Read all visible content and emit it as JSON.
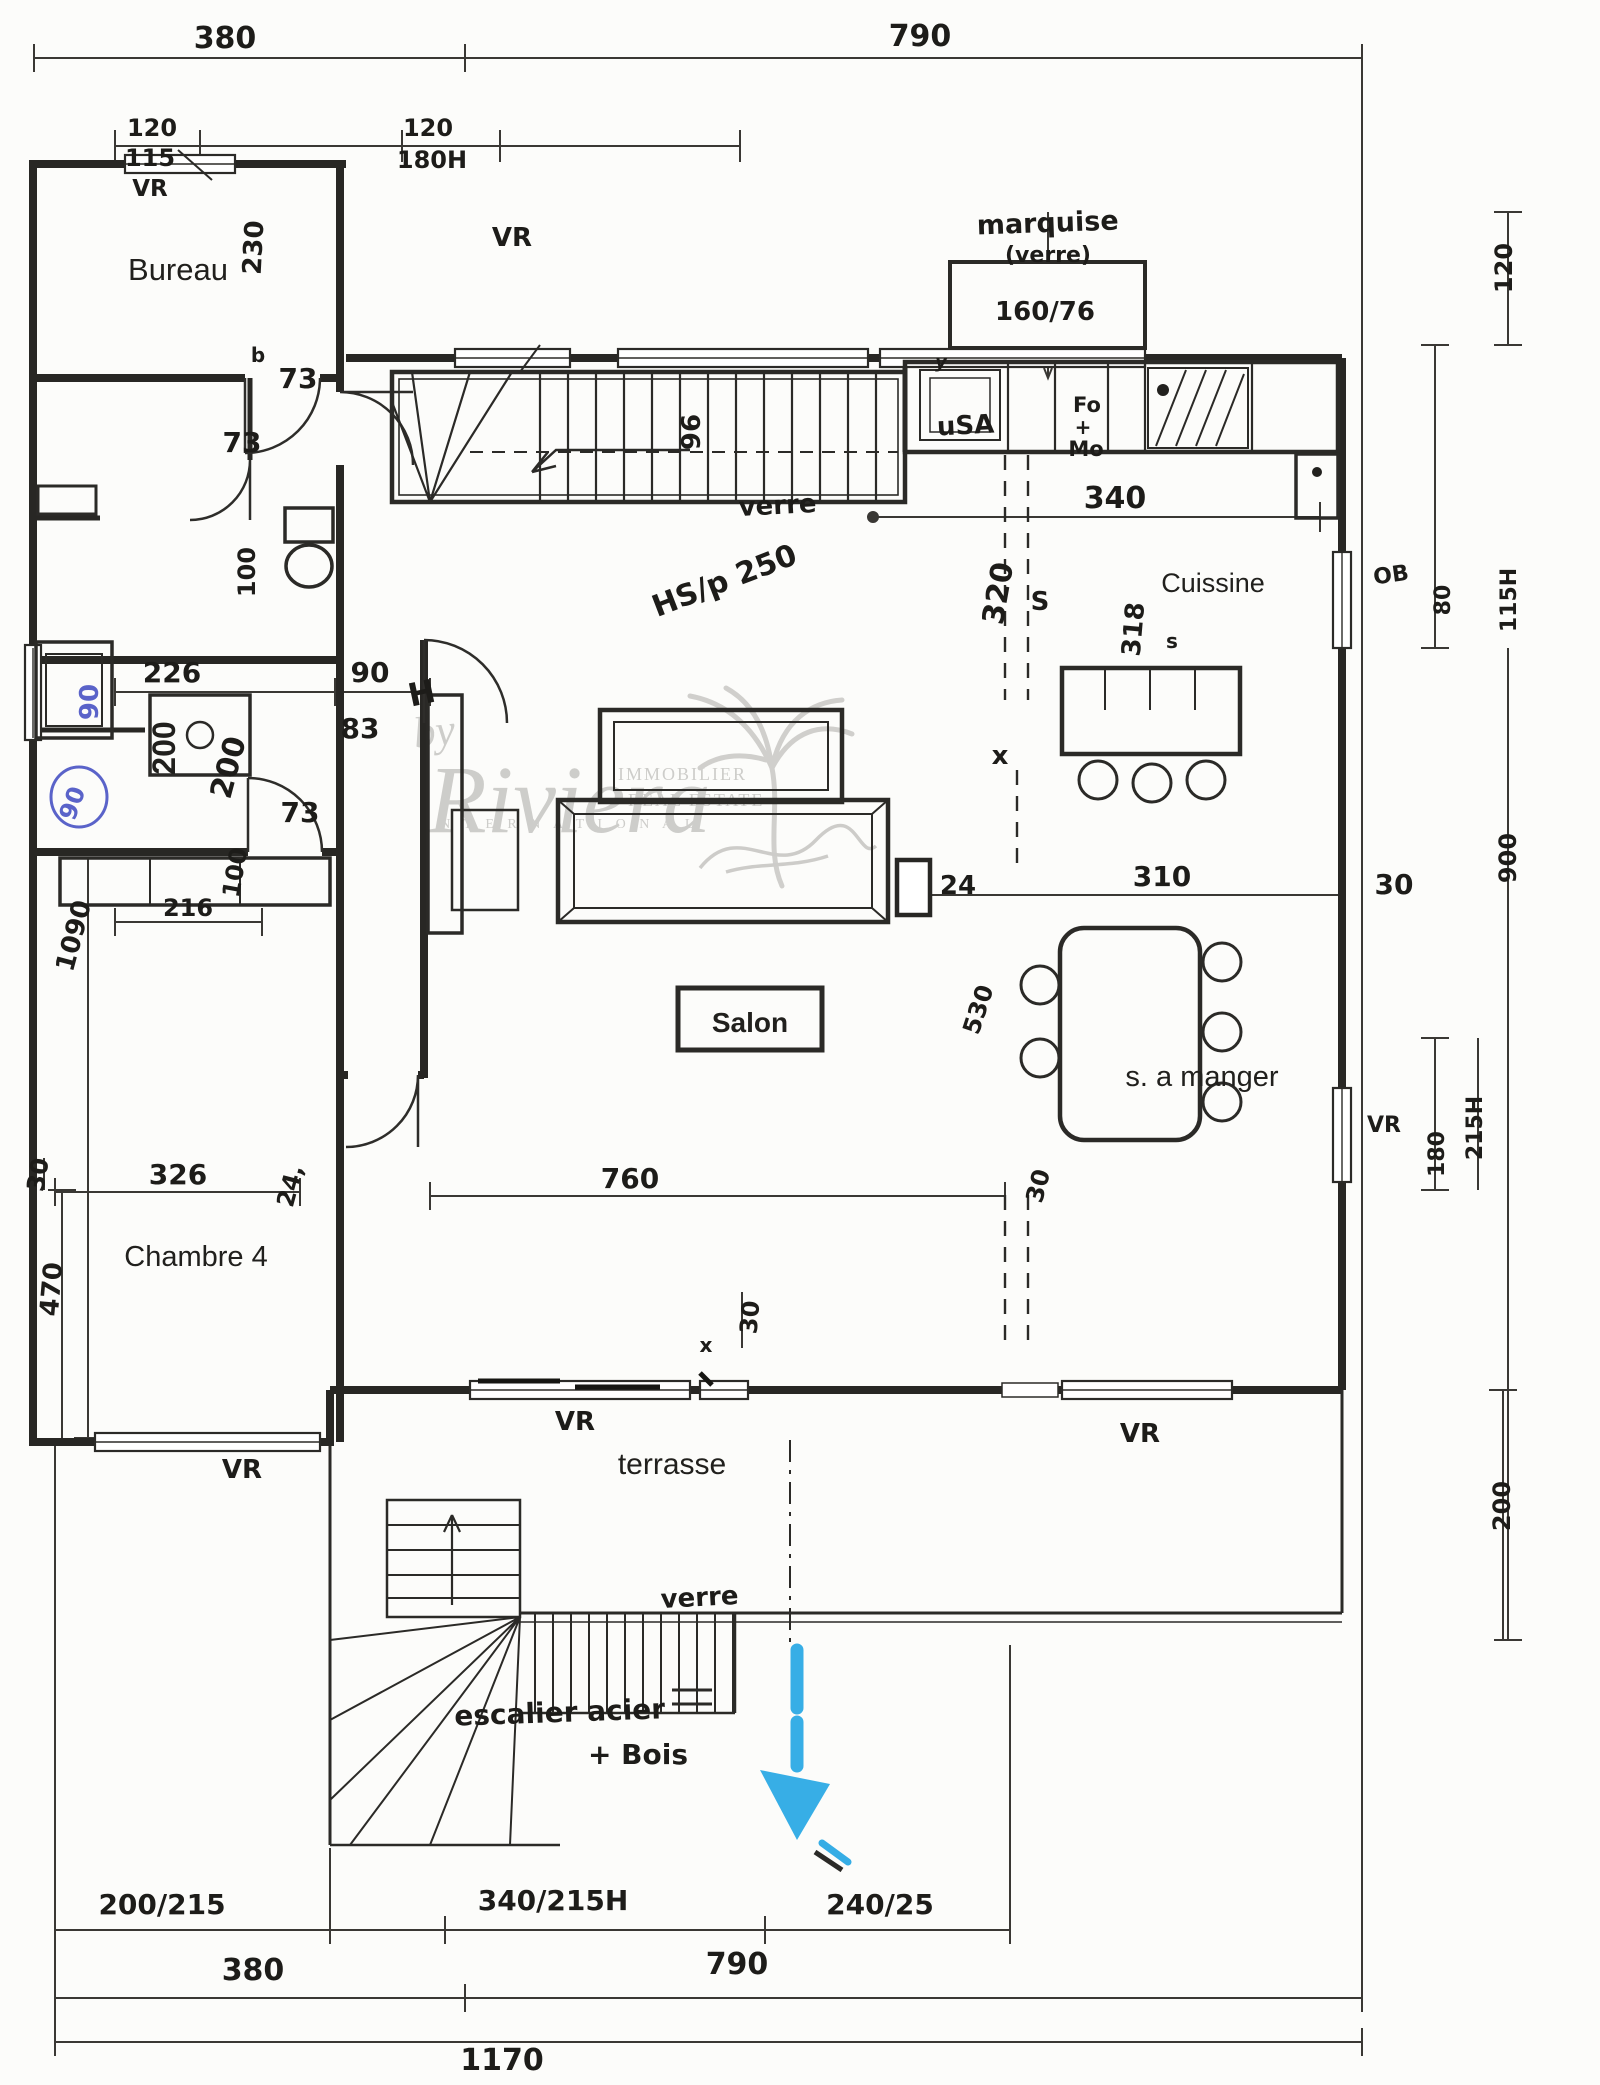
{
  "document": {
    "kind": "scanned hand-drawn floor plan",
    "language": "French"
  },
  "wm": {
    "by": "by",
    "brand": "Riviera",
    "l1": "IMMOBILIER",
    "l2": "REAL ESTATE",
    "l3": "I N T E R N A T I O N A L"
  },
  "rooms": {
    "bureau": "Bureau",
    "cuisine": "Cuissine",
    "chambre": "Chambre 4",
    "salon": "Salon",
    "manger": "s. a manger",
    "terrasse": "terrasse"
  },
  "lab": {
    "vr": "VR",
    "marquise": "marquise",
    "verre_p": "(verre)",
    "y": "y",
    "usa": "uSA",
    "fo": "Fo",
    "plus": "+",
    "mo": "Mo",
    "ob": "OB",
    "verre1": "verre",
    "verre2": "verre",
    "hsp": "HS/p 250",
    "x": "x",
    "b": "b",
    "h": "H",
    "esc1": "escalier acier",
    "esc2": "+ Bois"
  },
  "dim": {
    "t380": "380",
    "t790": "790",
    "t120a": "120",
    "t115": "115",
    "t120b": "120",
    "t180h": "180H",
    "mq": "160/76",
    "r120": "120",
    "r80": "80",
    "r115h": "115H",
    "r900": "900",
    "r215h": "215H",
    "r180": "180",
    "r200": "200",
    "b230": "230",
    "s96": "96",
    "k340": "340",
    "k320": "320",
    "kS": "S",
    "k318": "318",
    "ks": "s",
    "w100a": "100",
    "w226": "226",
    "h90": "90",
    "b90a": "90",
    "b90b": "90",
    "p200": "200",
    "h200": "200",
    "d83": "83",
    "d73a": "73",
    "d73b": "73",
    "d73c": "73",
    "w100b": "100",
    "l1090": "1090",
    "b216": "216",
    "s24": "24",
    "d310": "310",
    "r30": "30",
    "v530": "530",
    "l30": "30",
    "c326": "326",
    "c24": "24,",
    "s760": "760",
    "m30": "30",
    "bt30": "30",
    "c470": "470",
    "f200215": "200/215",
    "f340215": "340/215H",
    "f24025": "240/25",
    "f380": "380",
    "f790": "790",
    "f1170": "1170"
  }
}
